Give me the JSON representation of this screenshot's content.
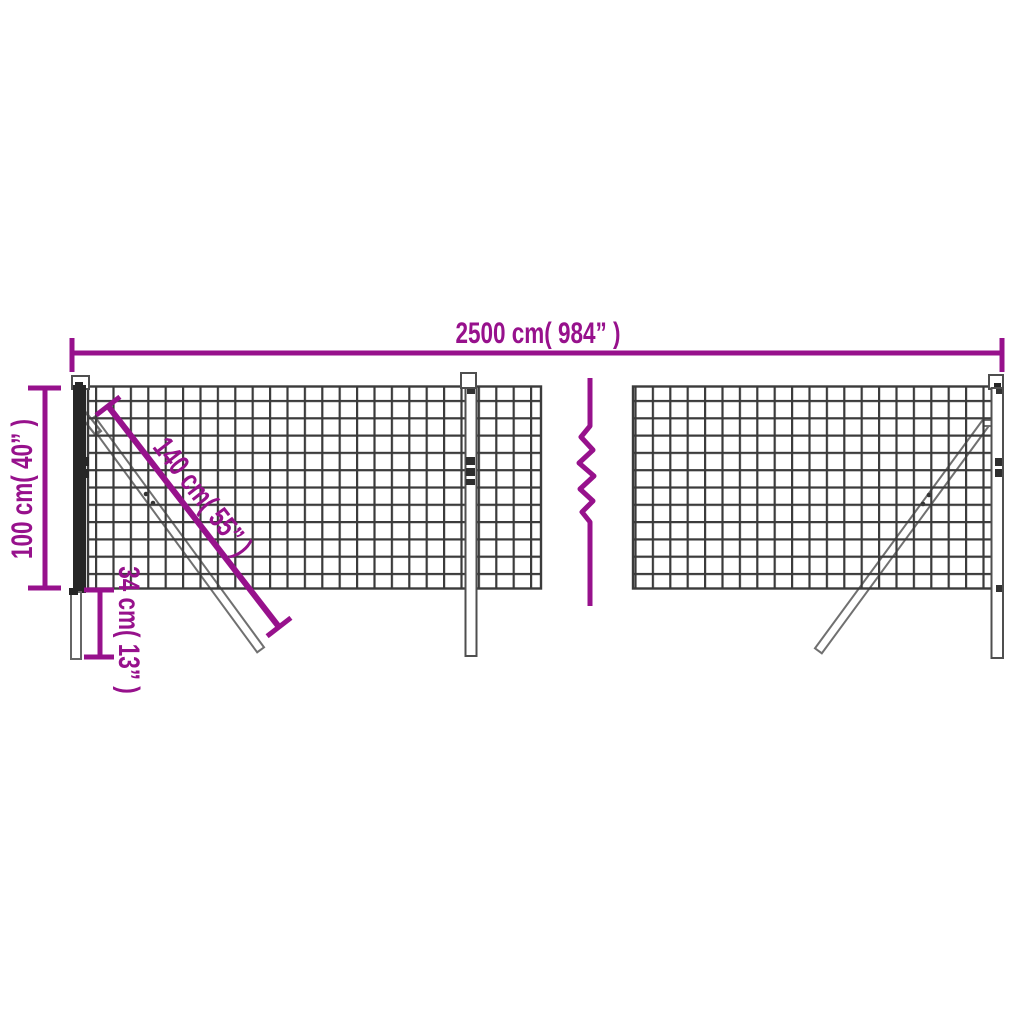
{
  "diagram": {
    "type": "dimension-diagram",
    "subject": "wire mesh fence with posts and diagonal braces, middle break symbol",
    "labels": {
      "total_width": "2500 cm( 984” )",
      "fence_height": "100 cm( 40” )",
      "brace_length": "140 cm( 55” )",
      "ground_offset": "34 cm( 13” )"
    },
    "colors": {
      "dimension_accent": "#97118C",
      "mesh_line": "#3B3B3B",
      "post_outline": "#4F4F4F",
      "post_dark_fill": "#262626",
      "brace_outline": "#707070",
      "background": "#FFFFFF"
    }
  }
}
